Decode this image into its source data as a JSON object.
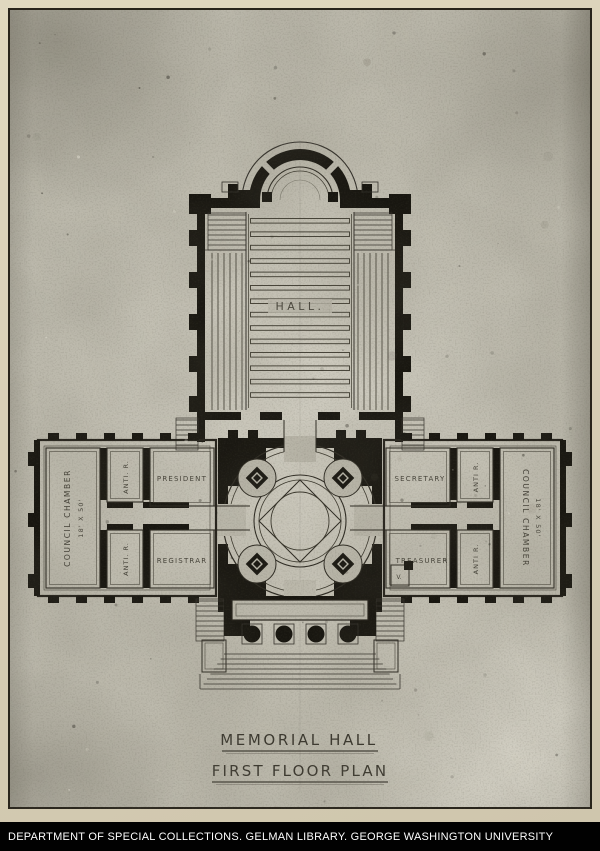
{
  "colors": {
    "paper": "#bcb9ac",
    "mount_border": "#d9d1b8",
    "frame_line": "#28241b",
    "ink": "#181610",
    "ink_light": "#3a372c",
    "footer_bg": "#010101",
    "footer_text": "#fdfdfd"
  },
  "plan": {
    "hall": "HALL.",
    "left_wing": {
      "council_chamber": "COUNCIL CHAMBER",
      "council_dims": "18' X 50'",
      "anti_top": "ANTI. R.",
      "president": "PRESIDENT",
      "anti_bottom": "ANTI. R.",
      "registrar": "REGISTRAR"
    },
    "right_wing": {
      "secretary": "SECRETARY",
      "anti_top": "ANTI R.",
      "council_chamber": "COUNCIL CHAMBER",
      "council_dims": "18' X 50'",
      "treasurer": "TREASURER",
      "anti_bottom": "ANTI R.",
      "vault": "V."
    }
  },
  "titles": {
    "line1": "MEMORIAL HALL",
    "line2": "FIRST FLOOR PLAN"
  },
  "footer": {
    "text": "DEPARTMENT OF SPECIAL COLLECTIONS. GELMAN LIBRARY. GEORGE WASHINGTON UNIVERSITY"
  }
}
